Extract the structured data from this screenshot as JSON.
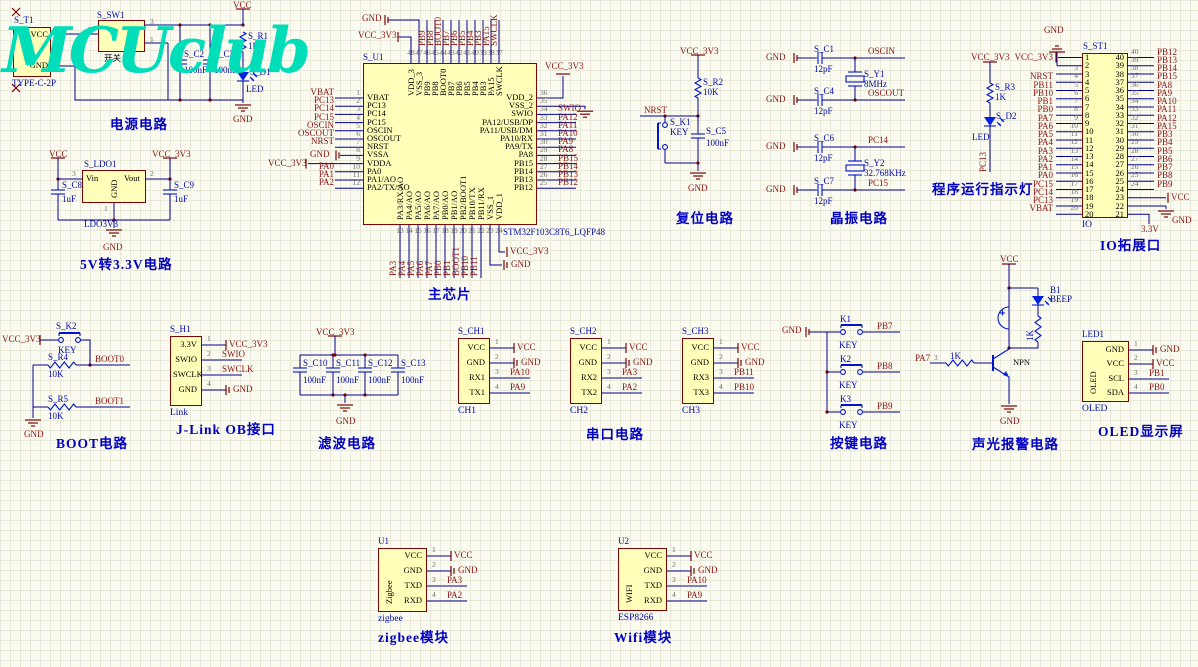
{
  "logo": {
    "text": "MCUclub"
  },
  "colors": {
    "wire": "#00008f",
    "component": "#0014cc",
    "net": "#8c1212",
    "designator": "#0009a8",
    "body_fill": "#ffffb9",
    "body_border": "#7a0505",
    "title": "#0000c2",
    "logo": "#00ddb9"
  },
  "blocks": {
    "power": {
      "title": "电源电路",
      "t1": {
        "designator": "S_T1",
        "part": "TYPE-C-2P",
        "pin_names": [
          "VCC",
          "GND"
        ],
        "pin_numbers": [
          "1",
          "2"
        ]
      },
      "sw1": {
        "designator": "S_SW1",
        "label": "开关",
        "pin_numbers": [
          "2",
          "3",
          "1"
        ]
      },
      "c2": {
        "d": "S_C2",
        "v": "100nF"
      },
      "c3": {
        "d": "S_C3",
        "v": "100nF"
      },
      "r1": {
        "d": "S_R1",
        "v": "1K"
      },
      "d1": {
        "d": "S_D1",
        "v": "LED"
      },
      "vcc": "VCC",
      "gnd": "GND"
    },
    "ldo": {
      "title": "5V转3.3V电路",
      "designator": "S_LDO1",
      "part": "LDO3V3",
      "pin_names": [
        "Vin",
        "Vout",
        "GND"
      ],
      "pin_numbers": [
        "3",
        "2",
        "1"
      ],
      "c8": {
        "d": "S_C8",
        "v": "1uF"
      },
      "c9": {
        "d": "S_C9",
        "v": "1uF"
      },
      "vcc": "VCC",
      "vcc33": "VCC_3V3",
      "gnd": "GND"
    },
    "chip": {
      "title": "主芯片",
      "designator": "S_U1",
      "part": "STM32F103C8T6_LQFP48",
      "top": {
        "numbers": [
          "48",
          "47",
          "46",
          "45",
          "44",
          "43",
          "42",
          "41",
          "40",
          "39",
          "38",
          "37"
        ],
        "names": [
          "VDD_3",
          "VSS_3",
          "PB9",
          "PB8",
          "BOOT0",
          "PB7",
          "PB6",
          "PB5",
          "PB4",
          "PB3",
          "PA15",
          "SWCLK"
        ],
        "nets": [
          "VCC_3V3",
          "GND",
          "PB9",
          "PB8",
          "BOOT0",
          "PB7",
          "PB6",
          "PB5",
          "PB4",
          "PB3",
          "PA15",
          "SWCLK"
        ]
      },
      "left": {
        "numbers": [
          "1",
          "2",
          "3",
          "4",
          "5",
          "6",
          "7",
          "8",
          "9",
          "10",
          "11",
          "12"
        ],
        "names": [
          "VBAT",
          "PC13",
          "PC14",
          "PC15",
          "OSCIN",
          "OSCOUT",
          "NRST",
          "VSSA",
          "VDDA",
          "PA0",
          "PA1/AO",
          "PA2/TX/AO"
        ],
        "nets": [
          "VBAT",
          "PC13",
          "PC14",
          "PC15",
          "OSCIN",
          "OSCOUT",
          "NRST",
          "GND",
          "VCC_3V3",
          "PA0",
          "PA1",
          "PA2"
        ]
      },
      "right": {
        "numbers": [
          "36",
          "35",
          "34",
          "33",
          "32",
          "31",
          "30",
          "29",
          "28",
          "27",
          "26",
          "25"
        ],
        "names": [
          "VDD_2",
          "VSS_2",
          "SWIO",
          "PA12/USB/DP",
          "PA11/USB/DM",
          "PA10/RX",
          "PA9/TX",
          "PA8",
          "PB15",
          "PB14",
          "PB13",
          "PB12"
        ],
        "nets": [
          "VCC_3V3",
          "GND",
          "SWIO",
          "PA12",
          "PA11",
          "PA10",
          "PA9",
          "PA8",
          "PB15",
          "PB14",
          "PB13",
          "PB12"
        ]
      },
      "bottom": {
        "numbers": [
          "13",
          "14",
          "15",
          "16",
          "17",
          "18",
          "19",
          "20",
          "21",
          "22",
          "23",
          "24"
        ],
        "names": [
          "PA3/RX/AO",
          "PA4/AO",
          "PA5/AO",
          "PA6/AO",
          "PA7/AO",
          "PB0/AO",
          "PB1/AO",
          "PB2/BOOT1",
          "PB10/TX",
          "PB11/RX",
          "VSS_1",
          "VDD_1"
        ],
        "nets": [
          "PA3",
          "PA4",
          "PA5",
          "PA6",
          "PA7",
          "PB0",
          "PB1",
          "BOOT1",
          "PB10",
          "PB11",
          "GND",
          "VCC_3V3"
        ]
      }
    },
    "reset": {
      "title": "复位电路",
      "vcc33": "VCC_3V3",
      "r2": {
        "d": "S_R2",
        "v": "10K"
      },
      "net": "NRST",
      "k1": {
        "d": "S_K1",
        "v": "KEY"
      },
      "c5": {
        "d": "S_C5",
        "v": "100nF"
      },
      "gnd": "GND"
    },
    "crystal": {
      "title": "晶振电路",
      "gnd": "GND",
      "c1": {
        "d": "S_C1",
        "v": "12pF"
      },
      "c4": {
        "d": "S_C4",
        "v": "12pF"
      },
      "c6": {
        "d": "S_C6",
        "v": "12pF"
      },
      "c7": {
        "d": "S_C7",
        "v": "12pF"
      },
      "y1": {
        "d": "S_Y1",
        "v": "8MHz"
      },
      "y2": {
        "d": "S_Y2",
        "v": "32.768KHz"
      },
      "nets": [
        "OSCIN",
        "OSCOUT",
        "PC14",
        "PC15"
      ]
    },
    "runled": {
      "title": "程序运行指示灯",
      "vcc33": "VCC_3V3",
      "r3": {
        "d": "S_R3",
        "v": "1K"
      },
      "d2": {
        "d": "S_D2",
        "v": "LED"
      },
      "net": "PC13"
    },
    "io": {
      "title": "IO拓展口",
      "designator": "S_ST1",
      "name": "IO",
      "gnd": "GND",
      "vcc33": "VCC_3V3",
      "left_numbers": [
        "1",
        "2",
        "3",
        "4",
        "5",
        "6",
        "7",
        "8",
        "9",
        "10",
        "11",
        "12",
        "13",
        "14",
        "15",
        "16",
        "17",
        "18",
        "19",
        "20"
      ],
      "right_numbers": [
        "40",
        "39",
        "38",
        "37",
        "36",
        "35",
        "34",
        "33",
        "32",
        "31",
        "30",
        "29",
        "28",
        "27",
        "26",
        "25",
        "24",
        "23",
        "22",
        "21"
      ],
      "left_nets": [
        "VCC_3V3",
        "GND",
        "",
        "NRST",
        "PB11",
        "PB10",
        "PB1",
        "PB0",
        "PA7",
        "PA6",
        "PA5",
        "PA4",
        "PA3",
        "PA2",
        "PA1",
        "PA0",
        "PC15",
        "PC14",
        "PC13",
        "VBAT"
      ],
      "right_nets": [
        "PB12",
        "PB13",
        "PB14",
        "PB15",
        "PA8",
        "PA9",
        "PA10",
        "PA11",
        "PA12",
        "PA15",
        "PB3",
        "PB4",
        "PB5",
        "PB6",
        "PB7",
        "PB8",
        "PB9",
        "VCC",
        "GND",
        "3.3V"
      ]
    },
    "boot": {
      "title": "BOOT电路",
      "vcc33": "VCC_3V3",
      "k2": {
        "d": "S_K2",
        "v": "KEY"
      },
      "r4": {
        "d": "S_R4",
        "v": "10K"
      },
      "r5": {
        "d": "S_R5",
        "v": "10K"
      },
      "boot0": "BOOT0",
      "boot1": "BOOT1",
      "gnd": "GND"
    },
    "jlink": {
      "title": "J-Link OB接口",
      "designator": "S_H1",
      "name": "Link",
      "pin_names": [
        "3.3V",
        "SWIO",
        "SWCLK",
        "GND"
      ],
      "pin_numbers": [
        "1",
        "2",
        "3",
        "4"
      ],
      "nets": [
        "VCC_3V3",
        "SWIO",
        "SWCLK",
        "GND"
      ]
    },
    "filter": {
      "title": "滤波电路",
      "vcc33": "VCC_3V3",
      "gnd": "GND",
      "caps": [
        {
          "d": "S_C10",
          "v": "100nF"
        },
        {
          "d": "S_C11",
          "v": "100nF"
        },
        {
          "d": "S_C12",
          "v": "100nF"
        },
        {
          "d": "S_C13",
          "v": "100nF"
        }
      ]
    },
    "serial": {
      "title": "串口电路",
      "channels": [
        {
          "designator": "S_CH1",
          "name": "CH1",
          "pin_names": [
            "VCC",
            "GND",
            "RX1",
            "TX1"
          ],
          "pin_numbers": [
            "1",
            "2",
            "3",
            "4"
          ],
          "nets": [
            "VCC",
            "GND",
            "PA10",
            "PA9"
          ]
        },
        {
          "designator": "S_CH2",
          "name": "CH2",
          "pin_names": [
            "VCC",
            "GND",
            "RX2",
            "TX2"
          ],
          "pin_numbers": [
            "1",
            "2",
            "3",
            "4"
          ],
          "nets": [
            "VCC",
            "GND",
            "PA3",
            "PA2"
          ]
        },
        {
          "designator": "S_CH3",
          "name": "CH3",
          "pin_names": [
            "VCC",
            "GND",
            "RX3",
            "TX3"
          ],
          "pin_numbers": [
            "1",
            "2",
            "3",
            "4"
          ],
          "nets": [
            "VCC",
            "GND",
            "PB11",
            "PB10"
          ]
        }
      ]
    },
    "keys": {
      "title": "按键电路",
      "gnd": "GND",
      "buttons": [
        {
          "d": "K1",
          "v": "KEY",
          "net": "PB7"
        },
        {
          "d": "K2",
          "v": "KEY",
          "net": "PB8"
        },
        {
          "d": "K3",
          "v": "KEY",
          "net": "PB9"
        }
      ]
    },
    "alarm": {
      "title": "声光报警电路",
      "vcc": "VCC",
      "gnd": "GND",
      "b1": {
        "d": "B1",
        "v": "BEEP"
      },
      "r_led": "1K",
      "r_base": "1K",
      "npn": "NPN",
      "net": "PA7",
      "base_pin": "3"
    },
    "oled": {
      "title": "OLED显示屏",
      "designator": "LED1",
      "name": "OLED",
      "body": "OLED",
      "pin_names": [
        "GND",
        "VCC",
        "SCL",
        "SDA"
      ],
      "pin_numbers": [
        "1",
        "2",
        "3",
        "4"
      ],
      "nets": [
        "GND",
        "VCC",
        "PB1",
        "PB0"
      ]
    },
    "zigbee": {
      "title": "zigbee模块",
      "designator": "U1",
      "name": "zigbee",
      "body": "Zigbee",
      "pin_names": [
        "VCC",
        "GND",
        "TXD",
        "RXD"
      ],
      "pin_numbers": [
        "1",
        "2",
        "3",
        "4"
      ],
      "nets": [
        "VCC",
        "GND",
        "PA3",
        "PA2"
      ]
    },
    "wifi": {
      "title": "Wifi模块",
      "designator": "U2",
      "name": "ESP8266",
      "body": "WIFI",
      "pin_names": [
        "VCC",
        "GND",
        "TXD",
        "RXD"
      ],
      "pin_numbers": [
        "1",
        "2",
        "3",
        "4"
      ],
      "nets": [
        "VCC",
        "GND",
        "PA10",
        "PA9"
      ]
    }
  }
}
